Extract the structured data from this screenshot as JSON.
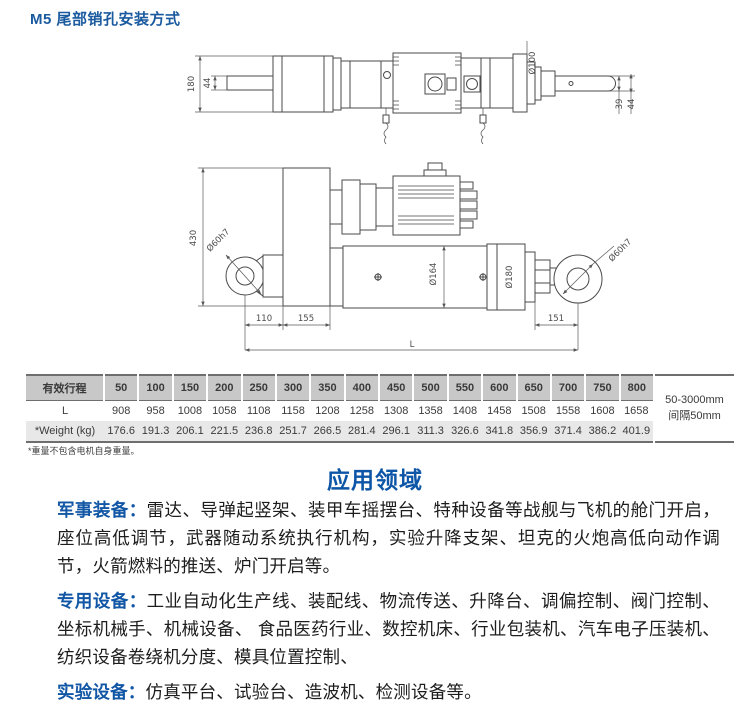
{
  "page_title": "M5 尾部销孔安装方式",
  "drawing": {
    "top_view": {
      "height": "180",
      "shaft": "44",
      "flange": "Ø100",
      "rod_a": "39",
      "rod_b": "44"
    },
    "side_view": {
      "height": "430",
      "pin_left": "Ø60h7",
      "cylinder": "Ø164",
      "end_cap": "Ø180",
      "pin_right": "Ø60h7",
      "a": "110",
      "b": "155",
      "c": "151",
      "total": "L"
    }
  },
  "table": {
    "row_labels": [
      "有效行程",
      "L",
      "*Weight (kg)"
    ],
    "stroke_values": [
      "50",
      "100",
      "150",
      "200",
      "250",
      "300",
      "350",
      "400",
      "450",
      "500",
      "550",
      "600",
      "650",
      "700",
      "750",
      "800"
    ],
    "L_values": [
      "908",
      "958",
      "1008",
      "1058",
      "1108",
      "1158",
      "1208",
      "1258",
      "1308",
      "1358",
      "1408",
      "1458",
      "1508",
      "1558",
      "1608",
      "1658"
    ],
    "weight_values": [
      "176.6",
      "191.3",
      "206.1",
      "221.5",
      "236.8",
      "251.7",
      "266.5",
      "281.4",
      "296.1",
      "311.3",
      "326.6",
      "341.8",
      "356.9",
      "371.4",
      "386.2",
      "401.9"
    ],
    "range_note_line1": "50-3000mm",
    "range_note_line2": "间隔50mm"
  },
  "footnote": "*重量不包含电机自身重量。",
  "applications": {
    "title": "应用领域",
    "items": [
      {
        "label": "军事装备：",
        "text": "雷达、导弹起竖架、装甲车摇摆台、特种设备等战舰与飞机的舱门开启，座位高低调节，武器随动系统执行机构，实验升降支架、坦克的火炮高低向动作调节，火箭燃料的推送、炉门开启等。"
      },
      {
        "label": "专用设备：",
        "text": "工业自动化生产线、装配线、物流传送、升降台、调偏控制、阀门控制、坐标机械手、机械设备、 食品医药行业、数控机床、行业包装机、汽车电子压装机、纺织设备卷绕机分度、模具位置控制、"
      },
      {
        "label": "实验设备：",
        "text": "仿真平台、试验台、造波机、检测设备等。"
      }
    ]
  },
  "colors": {
    "accent_blue": "#1257a5",
    "title_blue": "#0d55a6",
    "table_header_gray": "#c8c8c8",
    "table_row_gray": "#e8e8e8"
  }
}
